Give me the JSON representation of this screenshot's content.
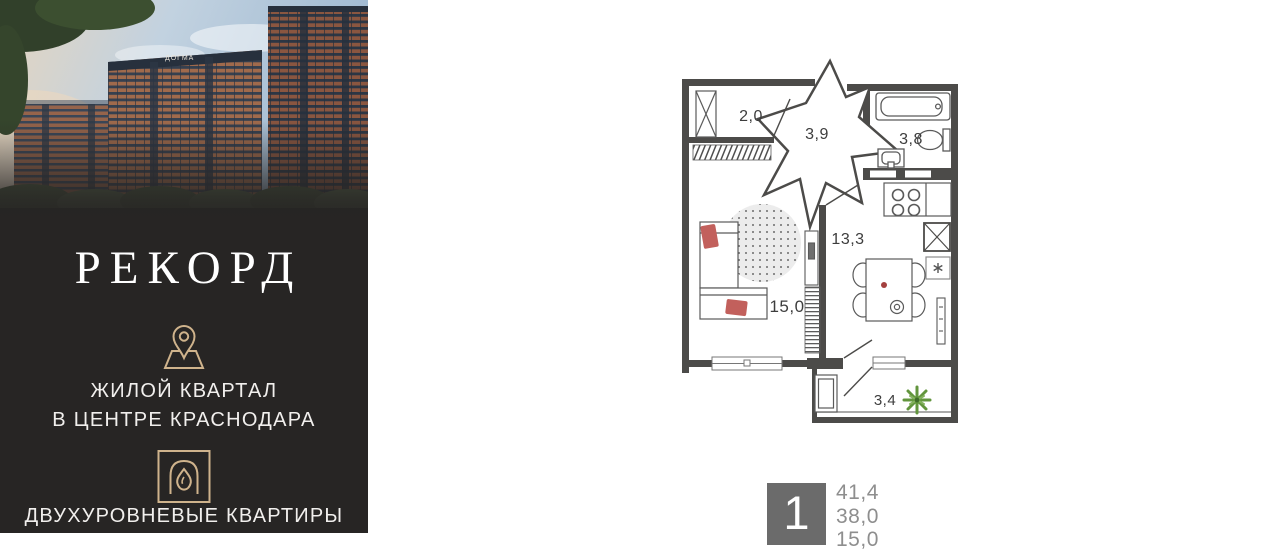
{
  "brand": {
    "name": "РЕКОРД",
    "tagline_line1": "ЖИЛОЙ КВАРТАЛ",
    "tagline_line2": "В ЦЕНТРЕ КРАСНОДАРА",
    "feature": "ДВУХУРОВНЕВЫЕ КВАРТИРЫ"
  },
  "photo": {
    "building_sign": "ДОГМА"
  },
  "floorplan": {
    "rooms": [
      {
        "name": "storage",
        "area": "2,0"
      },
      {
        "name": "hallway",
        "area": "3,9"
      },
      {
        "name": "bathroom",
        "area": "3,8"
      },
      {
        "name": "kitchen",
        "area": "13,3"
      },
      {
        "name": "living-room",
        "area": "15,0"
      },
      {
        "name": "balcony",
        "area": "3,4"
      }
    ]
  },
  "unit": {
    "rooms_count": "1",
    "area_total": "41,4",
    "area_secondary": "38,0",
    "area_living": "15,0"
  },
  "colors": {
    "panel_bg": "#272524",
    "accent_gold": "#cfb38c",
    "wall_gray": "#4c4b49",
    "pillow_red": "#c2605c",
    "plant_green": "#62953d",
    "unit_square_gray": "#6b6b6b",
    "values_gray": "#8e8e8e"
  }
}
